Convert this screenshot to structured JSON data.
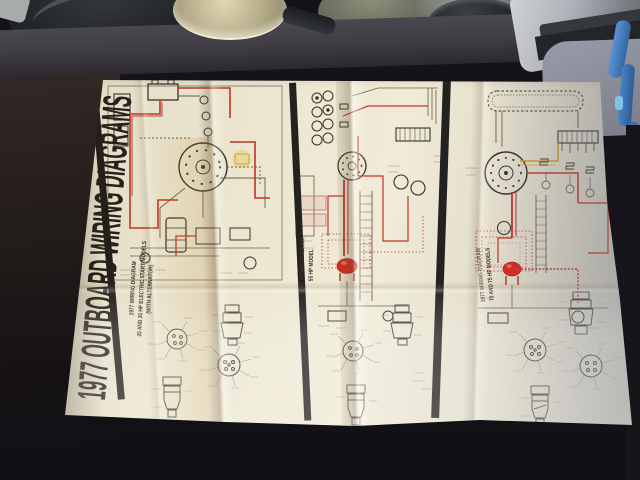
{
  "poster": {
    "title": "1977 OUTBOARD WIRING DIAGRAMS",
    "panels": [
      {
        "id": "panel-25-35hp",
        "caption": "1977 WIRING DIAGRAM\n25 AND 35 HP ELECTRIC START MODELS\n(WITH ALTERNATOR)"
      },
      {
        "id": "panel-55hp",
        "caption": "1977 WIRING DIAGRAM\n55 HP MODEL"
      },
      {
        "id": "panel-70-75hp",
        "caption": "1977 WIRING DIAGRAM\n70 AND 75 HP MODELS"
      }
    ]
  },
  "scene_objects": [
    "spare-tire",
    "metal-pot-lid",
    "metal-pots",
    "dark-bowl",
    "silver-pan",
    "gray-mat",
    "blue-pens",
    "table-edge"
  ],
  "palette": {
    "paper_cream": "#ece6d0",
    "ink_black": "#221e18",
    "diagram_line": "#6b5c49",
    "wire_red": "#c23327",
    "accent_yellow": "#d9b045",
    "background_dark": "#17151a",
    "table_band": "#3e3c42",
    "mat_gray": "#8b8e99",
    "pen_blue": "#4a82c4",
    "pan_silver": "#aeb2b8"
  }
}
